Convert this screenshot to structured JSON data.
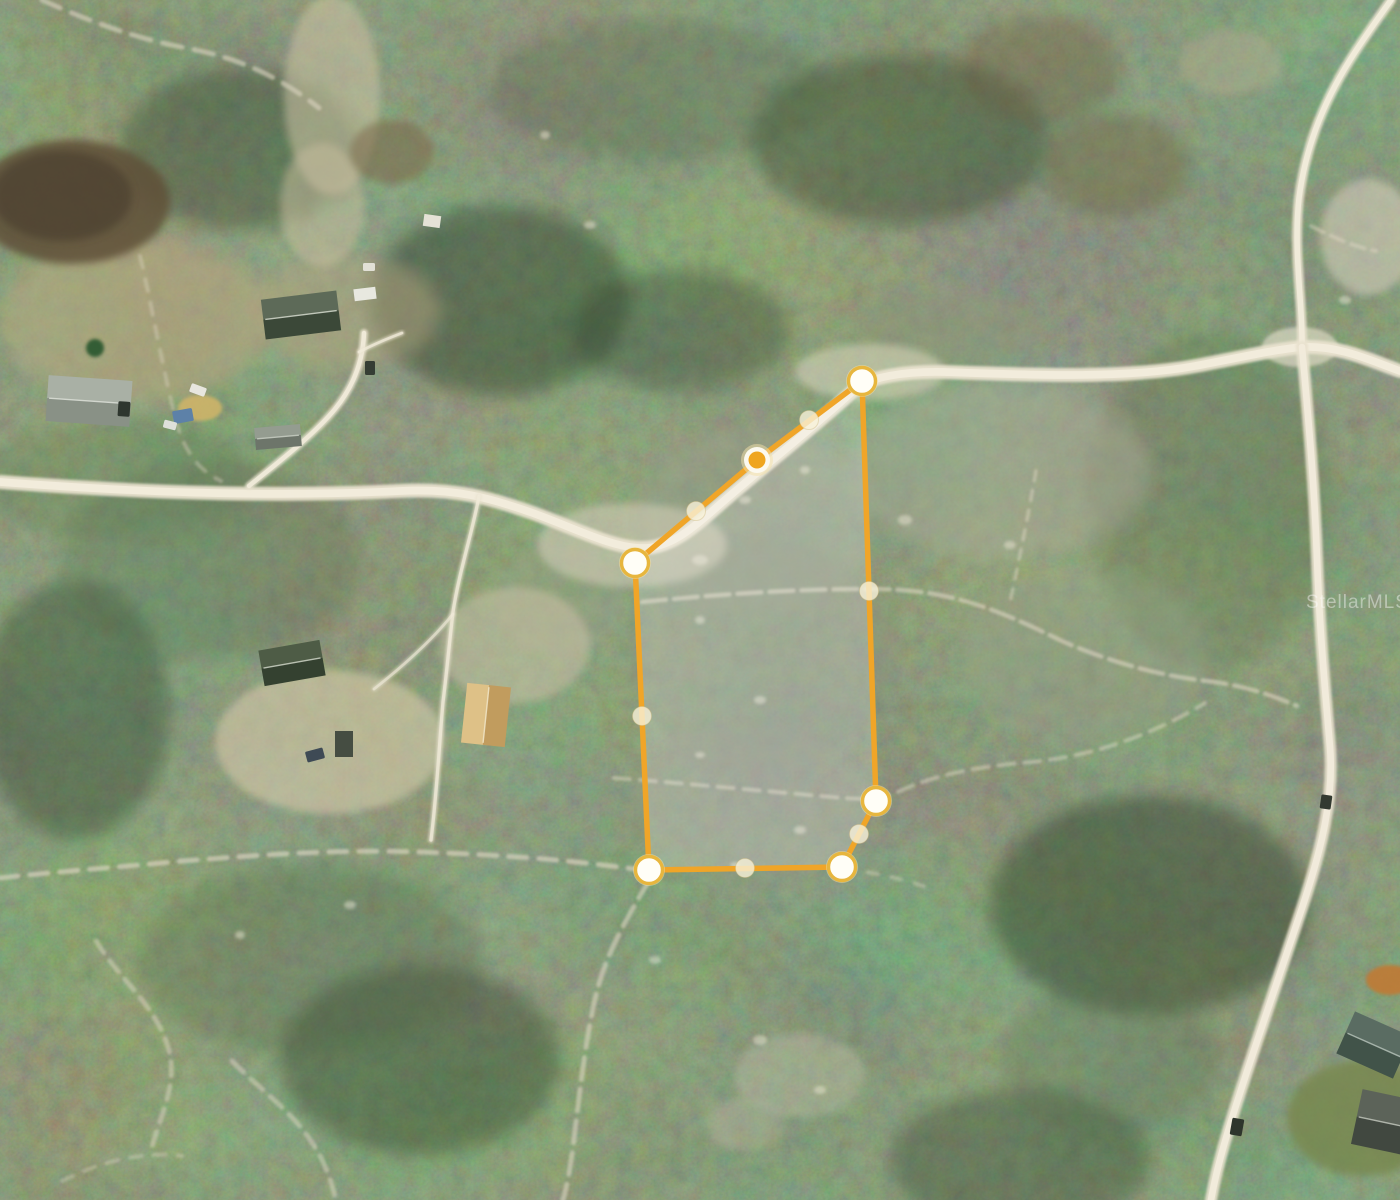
{
  "watermark": {
    "text": "StellarMLS."
  },
  "parcel": {
    "stroke_color": "#f0a528",
    "fill_color": "rgba(255,255,255,0.20)",
    "stroke_width": 5.5,
    "vertex_ring_color": "#e7b63e",
    "vertex_fill_color": "#fffef7",
    "selected_fill_color": "#efa51f",
    "midpoint_fill_color": "rgba(247,241,216,0.80)",
    "vertices": [
      {
        "x": 862,
        "y": 381,
        "selected": false
      },
      {
        "x": 757,
        "y": 460,
        "selected": true
      },
      {
        "x": 635,
        "y": 563,
        "selected": false
      },
      {
        "x": 649,
        "y": 870,
        "selected": false
      },
      {
        "x": 842,
        "y": 867,
        "selected": false
      },
      {
        "x": 876,
        "y": 801,
        "selected": false
      }
    ],
    "midpoints": [
      {
        "x": 809,
        "y": 420
      },
      {
        "x": 696,
        "y": 511
      },
      {
        "x": 642,
        "y": 716
      },
      {
        "x": 745,
        "y": 868
      },
      {
        "x": 859,
        "y": 834
      },
      {
        "x": 869,
        "y": 591
      }
    ]
  },
  "map": {
    "width": 1400,
    "height": 1200,
    "palette": {
      "forest_base": "#3e4d33",
      "road_casing": "#e9e2cf",
      "road_core": "#f2ecdc",
      "trail": "#ddd6c2",
      "scrub_gray": "#9aa18b",
      "sand": "#d8d1ba",
      "dirt_field": "#5e5038"
    },
    "patches": [
      {
        "cx": 500,
        "cy": 300,
        "rx": 130,
        "ry": 95,
        "fill": "#2c3a26",
        "op": 0.45,
        "blur": "l"
      },
      {
        "cx": 900,
        "cy": 140,
        "rx": 150,
        "ry": 85,
        "fill": "#2e3c28",
        "op": 0.4,
        "blur": "l"
      },
      {
        "cx": 1150,
        "cy": 905,
        "rx": 160,
        "ry": 110,
        "fill": "#2b3925",
        "op": 0.45,
        "blur": "l"
      },
      {
        "cx": 420,
        "cy": 1060,
        "rx": 140,
        "ry": 95,
        "fill": "#2d3b27",
        "op": 0.4,
        "blur": "l"
      },
      {
        "cx": 1020,
        "cy": 1160,
        "rx": 130,
        "ry": 70,
        "fill": "#2c3a26",
        "op": 0.35,
        "blur": "l"
      },
      {
        "cx": 75,
        "cy": 710,
        "rx": 95,
        "ry": 130,
        "fill": "#2e3c28",
        "op": 0.4,
        "blur": "l"
      },
      {
        "cx": 240,
        "cy": 150,
        "rx": 120,
        "ry": 80,
        "fill": "#30402a",
        "op": 0.4,
        "blur": "l"
      },
      {
        "cx": 680,
        "cy": 330,
        "rx": 110,
        "ry": 60,
        "fill": "#2f3e29",
        "op": 0.35,
        "blur": "l"
      },
      {
        "cx": 210,
        "cy": 560,
        "rx": 150,
        "ry": 100,
        "fill": "#56684a",
        "op": 0.3,
        "blur": "l"
      },
      {
        "cx": 1210,
        "cy": 500,
        "rx": 120,
        "ry": 170,
        "fill": "#53653f",
        "op": 0.28,
        "blur": "l"
      },
      {
        "cx": 660,
        "cy": 90,
        "rx": 170,
        "ry": 70,
        "fill": "#50623e",
        "op": 0.28,
        "blur": "l"
      },
      {
        "cx": 310,
        "cy": 960,
        "rx": 170,
        "ry": 95,
        "fill": "#4f613d",
        "op": 0.28,
        "blur": "l"
      },
      {
        "cx": 1110,
        "cy": 1060,
        "rx": 110,
        "ry": 75,
        "fill": "#55684a",
        "op": 0.28,
        "blur": "l"
      },
      {
        "cx": 120,
        "cy": 480,
        "rx": 140,
        "ry": 60,
        "fill": "#5a6c4a",
        "op": 0.25,
        "blur": "l"
      },
      {
        "cx": 755,
        "cy": 520,
        "rx": 120,
        "ry": 95,
        "fill": "#9aa18b",
        "op": 0.5,
        "blur": "l"
      },
      {
        "cx": 760,
        "cy": 655,
        "rx": 135,
        "ry": 120,
        "fill": "#8a917b",
        "op": 0.42,
        "blur": "l"
      },
      {
        "cx": 750,
        "cy": 805,
        "rx": 120,
        "ry": 80,
        "fill": "#8e9480",
        "op": 0.38,
        "blur": "l"
      },
      {
        "cx": 1000,
        "cy": 470,
        "rx": 150,
        "ry": 90,
        "fill": "#a9ac96",
        "op": 0.5,
        "blur": "l"
      },
      {
        "cx": 1085,
        "cy": 655,
        "rx": 125,
        "ry": 85,
        "fill": "#9aa089",
        "op": 0.4,
        "blur": "l"
      },
      {
        "cx": 950,
        "cy": 330,
        "rx": 95,
        "ry": 40,
        "fill": "#8f9478",
        "op": 0.4,
        "blur": "l"
      },
      {
        "cx": 560,
        "cy": 600,
        "rx": 65,
        "ry": 55,
        "fill": "#9aa089",
        "op": 0.4,
        "blur": "m"
      },
      {
        "cx": 632,
        "cy": 545,
        "rx": 95,
        "ry": 42,
        "fill": "#d8d1ba",
        "op": 0.55,
        "blur": "m"
      },
      {
        "cx": 870,
        "cy": 372,
        "rx": 75,
        "ry": 28,
        "fill": "#ddd6c0",
        "op": 0.55,
        "blur": "m"
      },
      {
        "cx": 1300,
        "cy": 347,
        "rx": 38,
        "ry": 20,
        "fill": "#e9e2cf",
        "op": 0.6,
        "blur": "s"
      },
      {
        "cx": 515,
        "cy": 645,
        "rx": 75,
        "ry": 58,
        "fill": "#cfc6aa",
        "op": 0.5,
        "blur": "m"
      },
      {
        "cx": 330,
        "cy": 742,
        "rx": 115,
        "ry": 72,
        "fill": "#d6cbab",
        "op": 0.6,
        "blur": "m"
      },
      {
        "cx": 135,
        "cy": 320,
        "rx": 135,
        "ry": 82,
        "fill": "#b9a981",
        "op": 0.55,
        "blur": "l"
      },
      {
        "cx": 345,
        "cy": 312,
        "rx": 95,
        "ry": 58,
        "fill": "#b3a47e",
        "op": 0.5,
        "blur": "l"
      },
      {
        "cx": 332,
        "cy": 95,
        "rx": 48,
        "ry": 100,
        "fill": "#cfc3a4",
        "op": 0.55,
        "blur": "m"
      },
      {
        "cx": 322,
        "cy": 205,
        "rx": 42,
        "ry": 62,
        "fill": "#c9bd9e",
        "op": 0.5,
        "blur": "m"
      },
      {
        "cx": 392,
        "cy": 152,
        "rx": 42,
        "ry": 32,
        "fill": "#7a6648",
        "op": 0.55,
        "blur": "m"
      },
      {
        "cx": 1368,
        "cy": 237,
        "rx": 48,
        "ry": 58,
        "fill": "#d8d2be",
        "op": 0.55,
        "blur": "m"
      },
      {
        "cx": 1230,
        "cy": 62,
        "rx": 52,
        "ry": 32,
        "fill": "#b7ae90",
        "op": 0.4,
        "blur": "m"
      },
      {
        "cx": 1115,
        "cy": 165,
        "rx": 75,
        "ry": 52,
        "fill": "#6f6044",
        "op": 0.45,
        "blur": "l"
      },
      {
        "cx": 1040,
        "cy": 70,
        "rx": 80,
        "ry": 55,
        "fill": "#6a5c40",
        "op": 0.4,
        "blur": "l"
      },
      {
        "cx": 800,
        "cy": 1075,
        "rx": 65,
        "ry": 42,
        "fill": "#cfc8b2",
        "op": 0.32,
        "blur": "m"
      },
      {
        "cx": 745,
        "cy": 1125,
        "rx": 40,
        "ry": 26,
        "fill": "#c8c1a8",
        "op": 0.3,
        "blur": "m"
      },
      {
        "cx": 72,
        "cy": 202,
        "rx": 98,
        "ry": 62,
        "fill": "#5e5038",
        "op": 0.85,
        "blur": "m"
      },
      {
        "cx": 62,
        "cy": 196,
        "rx": 70,
        "ry": 45,
        "fill": "#483e2d",
        "op": 0.65,
        "blur": "m"
      },
      {
        "cx": 1362,
        "cy": 1118,
        "rx": 75,
        "ry": 58,
        "fill": "#77874e",
        "op": 0.8,
        "blur": "m"
      },
      {
        "cx": 1390,
        "cy": 980,
        "rx": 24,
        "ry": 15,
        "fill": "#c07a35",
        "op": 0.9,
        "blur": "s"
      },
      {
        "cx": 200,
        "cy": 408,
        "rx": 22,
        "ry": 13,
        "fill": "#d2b569",
        "op": 0.85,
        "blur": "s"
      },
      {
        "cx": 95,
        "cy": 348,
        "rx": 9,
        "ry": 9,
        "fill": "#2f5a33",
        "op": 0.95,
        "blur": "s"
      }
    ],
    "roads": [
      {
        "d": "M0,482 C120,491 260,498 400,491 C455,488 490,498 530,512 C575,528 610,547 640,548 C668,549 690,531 718,506 C765,465 818,424 854,390 C868,377 905,371 945,372 C1030,375 1125,379 1195,366 C1243,357 1272,350 1302,347 C1340,345 1374,362 1400,371",
        "w": 14,
        "op": 0.95
      },
      {
        "d": "M1302,347 C1303,305 1293,252 1299,198 C1305,152 1320,108 1350,60 C1363,39 1379,17 1391,0",
        "w": 10,
        "op": 0.9
      },
      {
        "d": "M1302,347 C1308,415 1314,478 1317,558 C1320,638 1326,700 1330,747 C1334,797 1322,848 1302,908 C1282,968 1257,1040 1240,1093 C1228,1130 1217,1166 1211,1200",
        "w": 12,
        "op": 0.92
      },
      {
        "d": "M249,486 C272,467 312,437 335,409 C353,387 363,361 364,333",
        "w": 8,
        "op": 0.85
      },
      {
        "d": "M359,352 C374,344 389,338 402,333",
        "w": 5,
        "op": 0.7
      },
      {
        "d": "M479,496 C473,530 459,572 453,612 C449,646 447,670 443,702 C439,747 437,792 431,840",
        "w": 6,
        "op": 0.7
      },
      {
        "d": "M453,614 C432,640 402,667 374,689",
        "w": 5,
        "op": 0.55
      }
    ],
    "trails": [
      {
        "d": "M0,878 C62,871 122,867 182,861 C262,855 332,849 422,852 C502,855 562,859 642,870",
        "w": 5,
        "op": 0.65,
        "dash": "18 12"
      },
      {
        "d": "M844,869 C880,873 902,879 932,889",
        "w": 4,
        "op": 0.4,
        "dash": "10 14"
      },
      {
        "d": "M642,602 C702,596 782,589 868,589 C952,588 1002,612 1062,641 C1112,663 1162,676 1207,681 C1247,686 1274,696 1297,706",
        "w": 4.5,
        "op": 0.6,
        "dash": "24 8"
      },
      {
        "d": "M614,778 C682,783 762,791 832,797 C862,800 882,800 902,790 C942,772 992,765 1032,762 C1082,757 1142,741 1205,703",
        "w": 4,
        "op": 0.5,
        "dash": "16 10"
      },
      {
        "d": "M650,879 C631,911 607,951 597,991 C587,1031 581,1081 575,1131 C571,1166 567,1186 563,1200",
        "w": 5,
        "op": 0.6,
        "dash": "22 10"
      },
      {
        "d": "M42,0 C82,18 132,38 186,48 C241,58 281,78 319,108",
        "w": 5,
        "op": 0.6,
        "dash": "20 12"
      },
      {
        "d": "M140,256 C151,301 161,361 176,421 C186,456 201,471 221,481",
        "w": 4,
        "op": 0.4,
        "dash": "12 12"
      },
      {
        "d": "M96,941 C121,981 151,1001 166,1041 C181,1081 161,1111 151,1151",
        "w": 5,
        "op": 0.5,
        "dash": "14 10"
      },
      {
        "d": "M232,1061 C262,1091 291,1111 311,1141 C326,1163 331,1181 336,1200",
        "w": 5,
        "op": 0.5,
        "dash": "16 10"
      },
      {
        "d": "M62,1181 C102,1161 142,1151 182,1156",
        "w": 4,
        "op": 0.4,
        "dash": "12 12"
      },
      {
        "d": "M1036,471 C1029,511 1019,561 1009,607",
        "w": 3.5,
        "op": 0.5,
        "dash": "10 10"
      },
      {
        "d": "M1311,226 C1331,236 1351,246 1376,251",
        "w": 4,
        "op": 0.5,
        "dash": "14 8"
      }
    ],
    "buildings": [
      {
        "cx": 301,
        "cy": 315,
        "w": 76,
        "h": 40,
        "rot": -7,
        "axis": "h",
        "light": "#5d6a58",
        "dark": "#3b4838",
        "ridge": "#cdd3c6"
      },
      {
        "cx": 365,
        "cy": 294,
        "w": 22,
        "h": 12,
        "rot": -7,
        "fill": "#e8e8e0"
      },
      {
        "cx": 89,
        "cy": 401,
        "w": 84,
        "h": 46,
        "rot": 4,
        "axis": "h",
        "light": "#a9b0a5",
        "dark": "#899186",
        "ridge": "#d9ddd5"
      },
      {
        "cx": 278,
        "cy": 437,
        "w": 46,
        "h": 22,
        "rot": -5,
        "axis": "h",
        "light": "#949c90",
        "dark": "#6d756a",
        "ridge": "#c4cabf"
      },
      {
        "cx": 292,
        "cy": 663,
        "w": 62,
        "h": 36,
        "rot": -10,
        "axis": "h",
        "light": "#4e5c46",
        "dark": "#344130",
        "ridge": "#c6ccbe"
      },
      {
        "cx": 344,
        "cy": 744,
        "w": 18,
        "h": 26,
        "rot": 0,
        "fill": "#454d42"
      },
      {
        "cx": 486,
        "cy": 715,
        "w": 44,
        "h": 60,
        "rot": 6,
        "axis": "v",
        "light": "#dec187",
        "dark": "#c19c5e",
        "ridge": "#f0e4c4"
      },
      {
        "cx": 1374,
        "cy": 1045,
        "w": 62,
        "h": 46,
        "rot": 24,
        "axis": "h",
        "light": "#5a6c62",
        "dark": "#415349",
        "ridge": "#aebbb2"
      },
      {
        "cx": 1392,
        "cy": 1124,
        "w": 72,
        "h": 56,
        "rot": 12,
        "axis": "h",
        "light": "#5c6359",
        "dark": "#414840",
        "ridge": "#b9beb4"
      },
      {
        "cx": 432,
        "cy": 221,
        "w": 17,
        "h": 12,
        "rot": 8,
        "fill": "#e5e2d6"
      }
    ],
    "objects": [
      {
        "cx": 198,
        "cy": 390,
        "w": 16,
        "h": 9,
        "rot": 20,
        "fill": "#e8e6de"
      },
      {
        "cx": 370,
        "cy": 368,
        "w": 10,
        "h": 14,
        "rot": 0,
        "fill": "#353d34"
      },
      {
        "cx": 369,
        "cy": 267,
        "w": 12,
        "h": 8,
        "rot": 0,
        "fill": "#e2e0d6"
      },
      {
        "cx": 183,
        "cy": 416,
        "w": 20,
        "h": 13,
        "rot": -10,
        "fill": "#5d81a8"
      },
      {
        "cx": 170,
        "cy": 425,
        "w": 13,
        "h": 8,
        "rot": 15,
        "fill": "#dfe0da"
      },
      {
        "cx": 1237,
        "cy": 1127,
        "w": 12,
        "h": 17,
        "rot": 10,
        "fill": "#2e352c"
      },
      {
        "cx": 1326,
        "cy": 802,
        "w": 11,
        "h": 14,
        "rot": 8,
        "fill": "#333a31"
      },
      {
        "cx": 124,
        "cy": 409,
        "w": 12,
        "h": 15,
        "rot": 4,
        "fill": "#2e362e"
      },
      {
        "cx": 315,
        "cy": 755,
        "w": 18,
        "h": 11,
        "rot": -15,
        "fill": "#3e4a55"
      }
    ],
    "speckles": [
      {
        "x": 700,
        "y": 560,
        "rx": 8,
        "ry": 5
      },
      {
        "x": 745,
        "y": 500,
        "rx": 6,
        "ry": 4
      },
      {
        "x": 805,
        "y": 470,
        "rx": 5,
        "ry": 4
      },
      {
        "x": 700,
        "y": 620,
        "rx": 5,
        "ry": 4
      },
      {
        "x": 760,
        "y": 700,
        "rx": 6,
        "ry": 4
      },
      {
        "x": 700,
        "y": 755,
        "rx": 5,
        "ry": 3
      },
      {
        "x": 800,
        "y": 830,
        "rx": 6,
        "ry": 4
      },
      {
        "x": 735,
        "y": 865,
        "rx": 5,
        "ry": 3
      },
      {
        "x": 905,
        "y": 520,
        "rx": 7,
        "ry": 5
      },
      {
        "x": 1010,
        "y": 545,
        "rx": 6,
        "ry": 4
      },
      {
        "x": 655,
        "y": 960,
        "rx": 6,
        "ry": 4
      },
      {
        "x": 760,
        "y": 1040,
        "rx": 7,
        "ry": 5
      },
      {
        "x": 820,
        "y": 1090,
        "rx": 6,
        "ry": 4
      },
      {
        "x": 350,
        "y": 905,
        "rx": 6,
        "ry": 4
      },
      {
        "x": 240,
        "y": 935,
        "rx": 5,
        "ry": 4
      },
      {
        "x": 590,
        "y": 225,
        "rx": 6,
        "ry": 4
      },
      {
        "x": 545,
        "y": 135,
        "rx": 5,
        "ry": 4
      },
      {
        "x": 1345,
        "y": 300,
        "rx": 6,
        "ry": 4
      }
    ]
  }
}
